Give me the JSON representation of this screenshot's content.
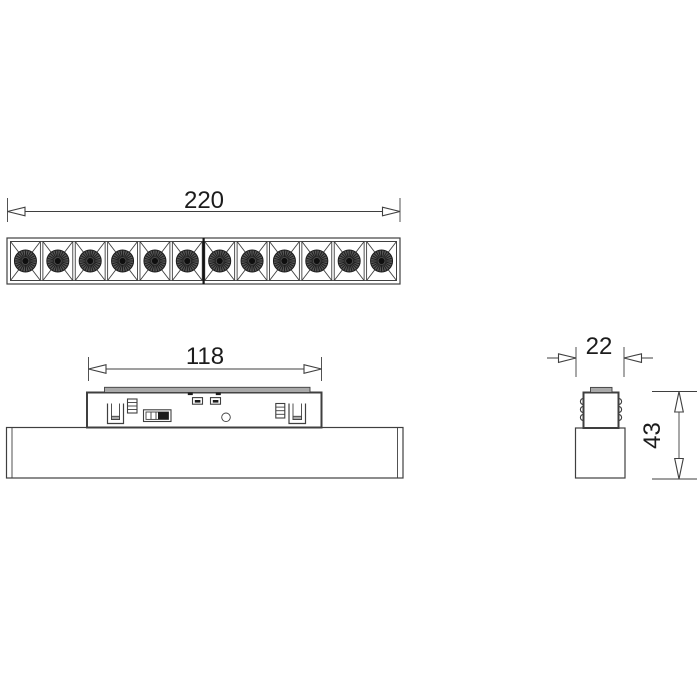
{
  "figure": {
    "type": "technical-drawing",
    "views": {
      "top": {
        "led_count": 12
      },
      "side": {
        "features": [
          "spring-clip-left",
          "terminal-block-left",
          "selector-switch",
          "connector-1",
          "connector-2",
          "indicator-circle",
          "terminal-block-right",
          "spring-clip-right",
          "track-rail-strip"
        ]
      },
      "end": {
        "features": [
          "fixture-body",
          "track-adapter",
          "spring-contacts",
          "top-cap"
        ]
      }
    }
  },
  "dimensions": {
    "overall_length": "220",
    "adapter_length": "118",
    "width": "22",
    "height": "43"
  },
  "colors": {
    "background": "#ffffff",
    "line": "#3f3f3f",
    "ink": "#1b1b1b",
    "gray_fill": "#a9a9a9",
    "led_base": "#575757",
    "led_center": "#0f0f0f"
  }
}
